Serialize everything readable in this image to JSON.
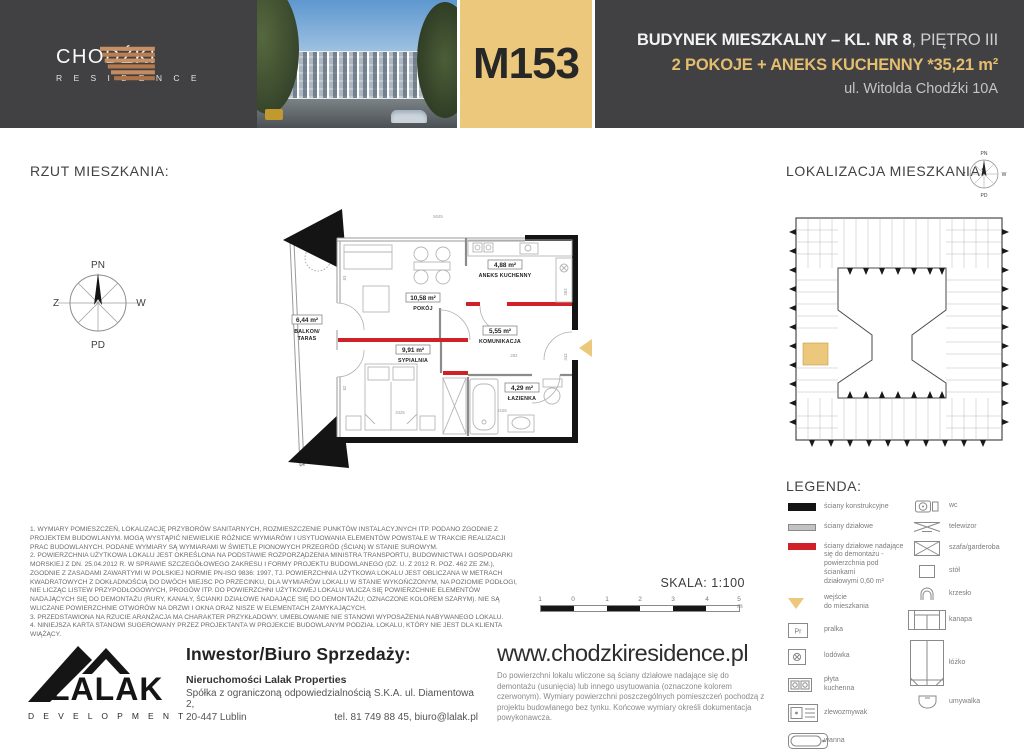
{
  "header": {
    "brand": {
      "name": "CHODŹKI",
      "subname": "R E S I D E N C E"
    },
    "unit_code": "M153",
    "line1_bold": "BUDYNEK MIESZKALNY – KL. NR 8",
    "line1_light": ", PIĘTRO III",
    "line2": "2 POKOJE + ANEKS KUCHENNY *35,21 m²",
    "line3": "ul. Witolda Chodźki 10A",
    "colors": {
      "accent_gold": "#ecc87c",
      "header_bg": "#414144",
      "removable_wall_red": "#cf2127"
    }
  },
  "floorplan": {
    "title": "RZUT MIESZKANIA:",
    "compass": {
      "north": "PN",
      "south": "PD",
      "west": "Z",
      "east": "W"
    },
    "rooms": {
      "balkon": {
        "area": "6,44 m²",
        "name1": "BALKON/",
        "name2": "TARAS"
      },
      "pokoj": {
        "area": "10,58 m²",
        "name": "POKÓJ"
      },
      "aneks": {
        "area": "4,88 m²",
        "name": "ANEKS KUCHENNY"
      },
      "komunikacja": {
        "area": "5,55 m²",
        "name": "KOMUNIKACJA"
      },
      "sypialnia": {
        "area": "9,91 m²",
        "name": "SYPIALNIA"
      },
      "lazienka": {
        "area": "4,29 m²",
        "name": "ŁAZIENKA"
      }
    },
    "dims": {
      "d1": "5045",
      "d2": "3425",
      "d3": "2155",
      "d4": "282",
      "d5": "363",
      "d6": "343",
      "d7": "83",
      "d8": "82"
    }
  },
  "location": {
    "title": "LOKALIZACJA MIESZKANIA:"
  },
  "legend": {
    "title": "LEGENDA:",
    "left": [
      {
        "icon": "structural-wall",
        "label": "ściany konstrukcyjne"
      },
      {
        "icon": "partition-wall",
        "label": "ściany działowe"
      },
      {
        "icon": "removable-wall",
        "label": "ściany działowe nadające\nsię do demontażu -\npowierzchnia pod ściankami\ndziałowymi 0,60 m²"
      },
      {
        "icon": "entrance-arrow",
        "label": "wejście\ndo mieszkania"
      },
      {
        "icon": "washer",
        "symbol": "Pr",
        "label": "pralka"
      },
      {
        "icon": "fridge",
        "label": "lodówka"
      },
      {
        "icon": "hob",
        "label": "płyta\nkuchenna"
      },
      {
        "icon": "sink",
        "label": "zlewozmywak"
      },
      {
        "icon": "bathtub",
        "label": "wanna"
      }
    ],
    "right": [
      {
        "icon": "wc",
        "label": "wc"
      },
      {
        "icon": "tv",
        "label": "telewizor"
      },
      {
        "icon": "wardrobe",
        "label": "szafa/garderoba"
      },
      {
        "icon": "table",
        "label": "stół"
      },
      {
        "icon": "chair",
        "label": "krzesło"
      },
      {
        "icon": "sofa",
        "label": "kanapa"
      },
      {
        "icon": "bed",
        "label": "łóżko"
      },
      {
        "icon": "washbasin",
        "label": "umywalka"
      }
    ]
  },
  "scale": {
    "label": "SKALA: 1:100",
    "ticks": [
      "1",
      "0",
      "1",
      "2",
      "3",
      "4",
      "5 m"
    ]
  },
  "notes": [
    "1. WYMIARY POMIESZCZEŃ, LOKALIZACJĘ PRZYBORÓW SANITARNYCH, ROZMIESZCZENIE PUNKTÓW INSTALACYJNYCH ITP. PODANO ZGODNIE Z PROJEKTEM BUDOWLANYM. MOGĄ WYSTĄPIĆ NIEWIELKIE RÓŻNICE WYMIARÓW I USYTUOWANIA ELEMENTÓW POWSTAŁE W TRAKCIE REALIZACJI PRAC BUDOWLANYCH. PODANE WYMIARY SĄ WYMIARAMI W ŚWIETLE PIONOWYCH PRZEGRÓD (ŚCIAN) W STANIE SUROWYM.",
    "2. POWIERZCHNIA UŻYTKOWA LOKALU JEST OKREŚLONA NA PODSTAWIE ROZPORZĄDZENIA MINISTRA TRANSPORTU, BUDOWNICTWA I GOSPODARKI MORSKIEJ Z DN. 25.04.2012 R. W SPRAWIE SZCZEGÓŁOWEGO ZAKRESU I FORMY PROJEKTU BUDOWLANEGO (DZ. U. Z 2012 R. POZ. 462 ZE ZM.), ZGODNIE Z ZASADAMI ZAWARTYMI W POLSKIEJ NORMIE PN-ISO 9836: 1997, TJ. POWIERZCHNIA UŻYTKOWA LOKALU JEST OBLICZANA W METRACH KWADRATOWYCH Z DOKŁADNOŚCIĄ DO DWÓCH MIEJSC PO PRZECINKU, DLA WYMIARÓW LOKALU W STANIE WYKOŃCZONYM, NA POZIOMIE PODŁOGI, NIE LICZĄC LISTEW PRZYPODŁOGOWYCH, PROGÓW ITP. DO POWIERZCHNI UŻYTKOWEJ LOKALU WLICZA SIĘ POWIERZCHNIE ELEMENTÓW NADAJĄCYCH SIĘ DO DEMONTAŻU (RURY, KANAŁY, ŚCIANKI DZIAŁOWE NADAJĄCE SIĘ DO DEMONTAŻU; OZNACZONE KOLOREM SZARYM). NIE SĄ WLICZANE POWIERZCHNIE OTWORÓW NA DRZWI I OKNA ORAZ NISZE W ELEMENTACH ZAMYKAJĄCYCH.",
    "3. PRZEDSTAWIONA NA RZUCIE ARANŻACJA MA CHARAKTER PRZYKŁADOWY. UMEBLOWANIE NIE STANOWI WYPOSAŻENIA NABYWANEGO LOKALU.",
    "4. NINIEJSZA KARTA STANOWI SUGEROWANY PRZEZ PROJEKTANTA W PROJEKCIE BUDOWLANYM PODZIAŁ LOKALU, KTÓRY NIE JEST DLA KLIENTA WIĄŻĄCY."
  ],
  "footer": {
    "investor_heading": "Inwestor/Biuro Sprzedaży:",
    "company": "Nieruchomości Lalak Properties",
    "company_line2": "Spółka z ograniczoną odpowiedzialnością S.K.A. ul. Diamentowa 2,",
    "city": "20-447 Lublin",
    "contact": "tel. 81 749 88 45, biuro@lalak.pl",
    "website": "www.chodzkiresidence.pl",
    "website_note": "Do powierzchni lokalu wliczone są ściany działowe nadające się do demontażu (usunięcia) lub innego usytuowania (oznaczone kolorem czerwonym). Wymiary powierzchni poszczególnych pomieszczeń pochodzą z projektu budowlanego bez tynku. Końcowe wymiary określi dokumentacja powykonawcza.",
    "logo": {
      "name": "LALAK",
      "sub": "D E V E L O P M E N T"
    }
  }
}
